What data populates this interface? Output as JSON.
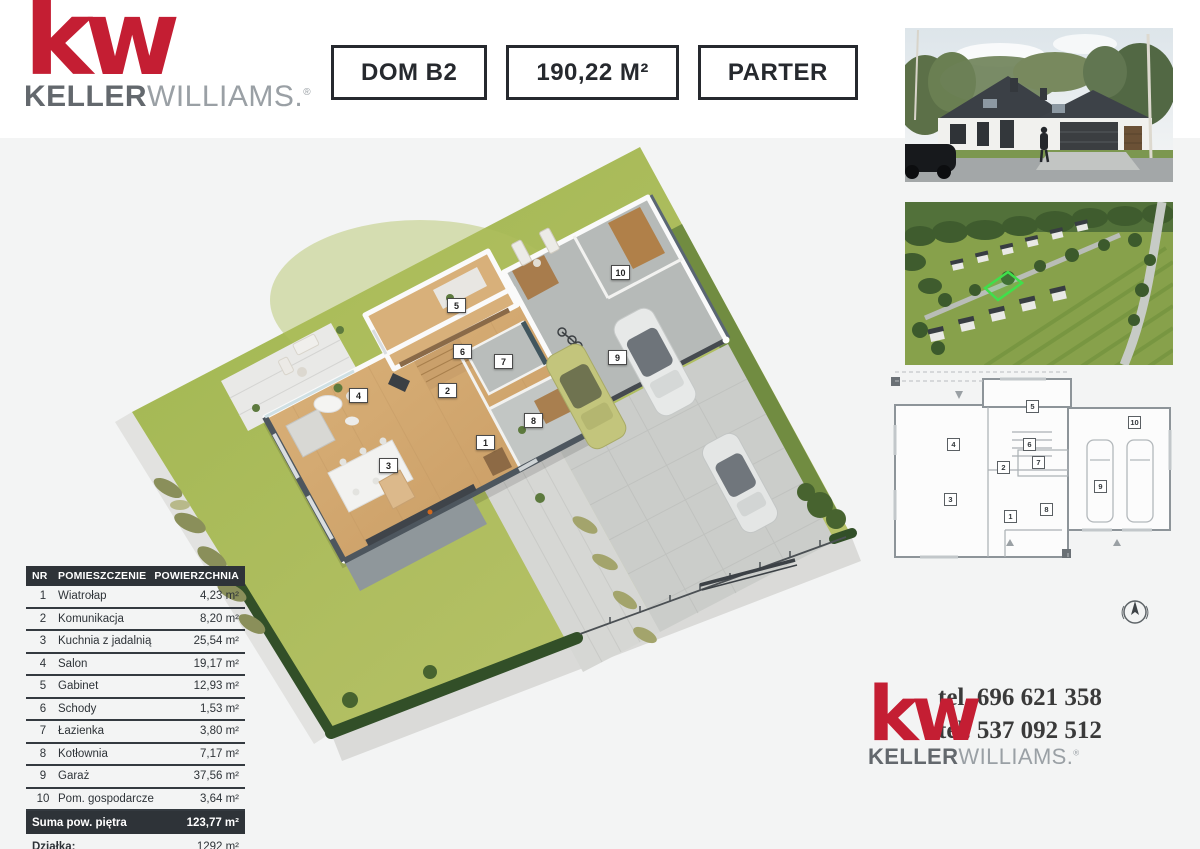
{
  "brand": {
    "logo_mark": "kw",
    "name_bold": "KELLER",
    "name_light": "WILLIAMS.",
    "registered": "®",
    "red": "#c41e33",
    "gray_dark": "#63686d",
    "gray_light": "#9aa0a5"
  },
  "header": {
    "badges": [
      {
        "label": "DOM B2"
      },
      {
        "label": "190,22 M²"
      },
      {
        "label": "PARTER"
      }
    ]
  },
  "table": {
    "headers": {
      "nr": "NR",
      "room": "POMIESZCZENIE",
      "area": "POWIERZCHNIA"
    },
    "rooms": [
      {
        "nr": "1",
        "name": "Wiatrołap",
        "area": "4,23 m²"
      },
      {
        "nr": "2",
        "name": "Komunikacja",
        "area": "8,20 m²"
      },
      {
        "nr": "3",
        "name": "Kuchnia z jadalnią",
        "area": "25,54 m²"
      },
      {
        "nr": "4",
        "name": "Salon",
        "area": "19,17 m²"
      },
      {
        "nr": "5",
        "name": "Gabinet",
        "area": "12,93 m²"
      },
      {
        "nr": "6",
        "name": "Schody",
        "area": "1,53 m²"
      },
      {
        "nr": "7",
        "name": "Łazienka",
        "area": "3,80 m²"
      },
      {
        "nr": "8",
        "name": "Kotłownia",
        "area": "7,17 m²"
      },
      {
        "nr": "9",
        "name": "Garaż",
        "area": "37,56 m²"
      },
      {
        "nr": "10",
        "name": "Pom. gospodarcze",
        "area": "3,64 m²"
      }
    ],
    "summary": {
      "label": "Suma pow. piętra",
      "value": "123,77 m²"
    },
    "plot": {
      "label": "Działka:",
      "value": "1292 m²"
    }
  },
  "contact": {
    "phone1": "tel. 696 621 358",
    "phone2": "tel. 537 092 512"
  },
  "colors": {
    "table_dark": "#2e3338",
    "lawn_green": "#a9bb58",
    "hedge_green": "#324f28",
    "wood_floor": "#d2a96f",
    "highlight_plot_outline": "#3fe04b"
  }
}
